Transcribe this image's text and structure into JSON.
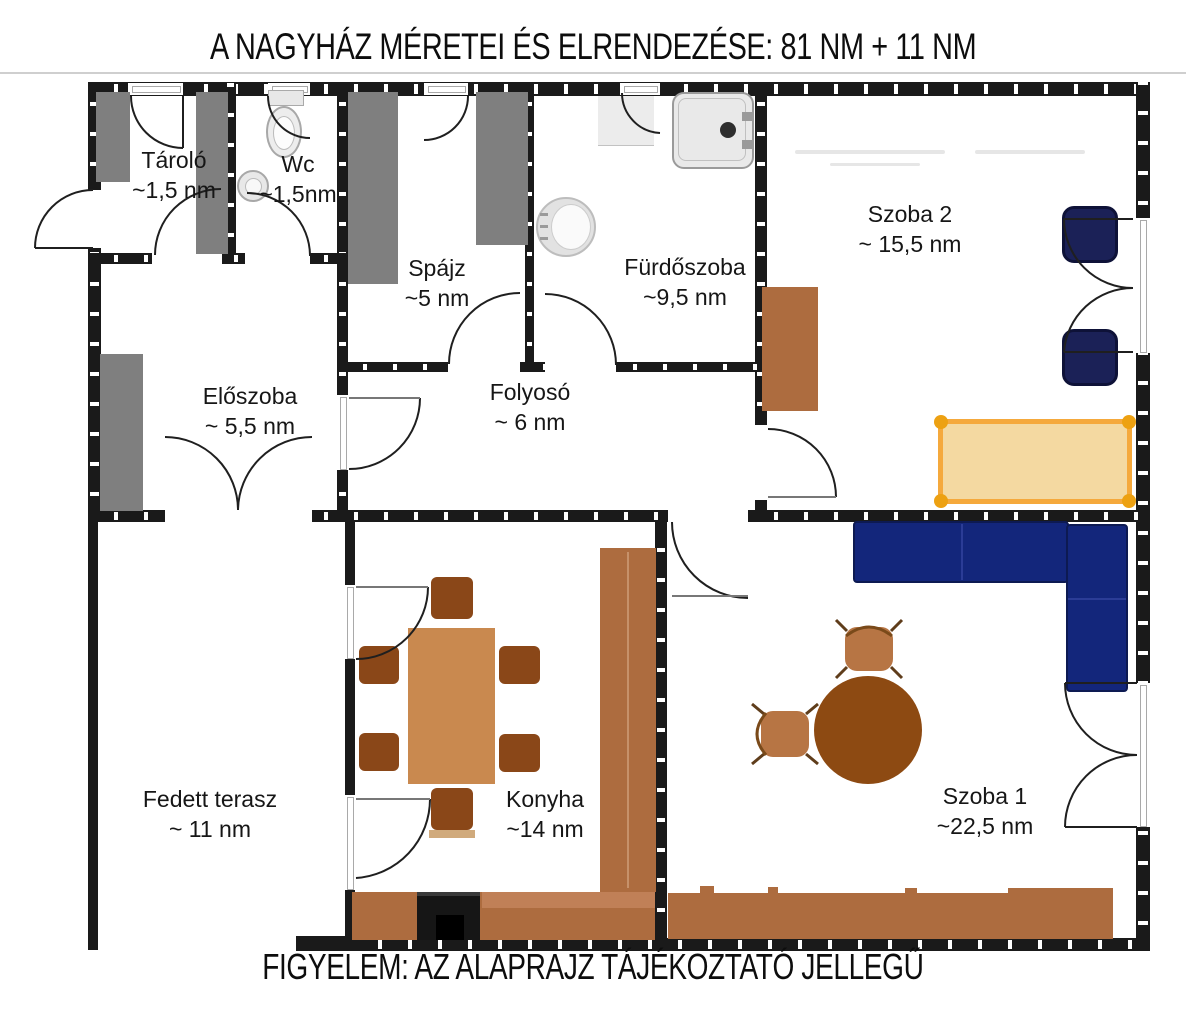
{
  "title": "A NAGYHÁZ MÉRETEI ÉS ELRENDEZÉSE: 81 NM + 11 NM",
  "caption": "FIGYELEM: AZ ALAPRAJZ TÁJÉKOZTATÓ JELLEGŰ",
  "rooms": {
    "tarolo": {
      "name": "Tároló",
      "area": "~1,5 nm"
    },
    "wc": {
      "name": "Wc",
      "area": "~1,5nm"
    },
    "spajz": {
      "name": "Spájz",
      "area": "~5 nm"
    },
    "furdoszoba": {
      "name": "Fürdőszoba",
      "area": "~9,5 nm"
    },
    "szoba2": {
      "name": "Szoba 2",
      "area": "~ 15,5 nm"
    },
    "eloszoba": {
      "name": "Előszoba",
      "area": "~ 5,5 nm"
    },
    "folyoso": {
      "name": "Folyosó",
      "area": "~ 6 nm"
    },
    "terasz": {
      "name": "Fedett terasz",
      "area": "~ 11 nm"
    },
    "konyha": {
      "name": "Konyha",
      "area": "~14 nm"
    },
    "szoba1": {
      "name": "Szoba 1",
      "area": "~22,5 nm"
    }
  },
  "colors": {
    "wall": "#1a1a1a",
    "gray": "#7f7f7f",
    "brown": "#ad6c3f",
    "brown_dark": "#8a4718",
    "table_light": "#c9894f",
    "navy": "#13267b",
    "navy_dark": "#1b2157",
    "bed_fill": "#f4d9a1",
    "bed_border": "#f5a93c",
    "bed_dot": "#eda112"
  }
}
